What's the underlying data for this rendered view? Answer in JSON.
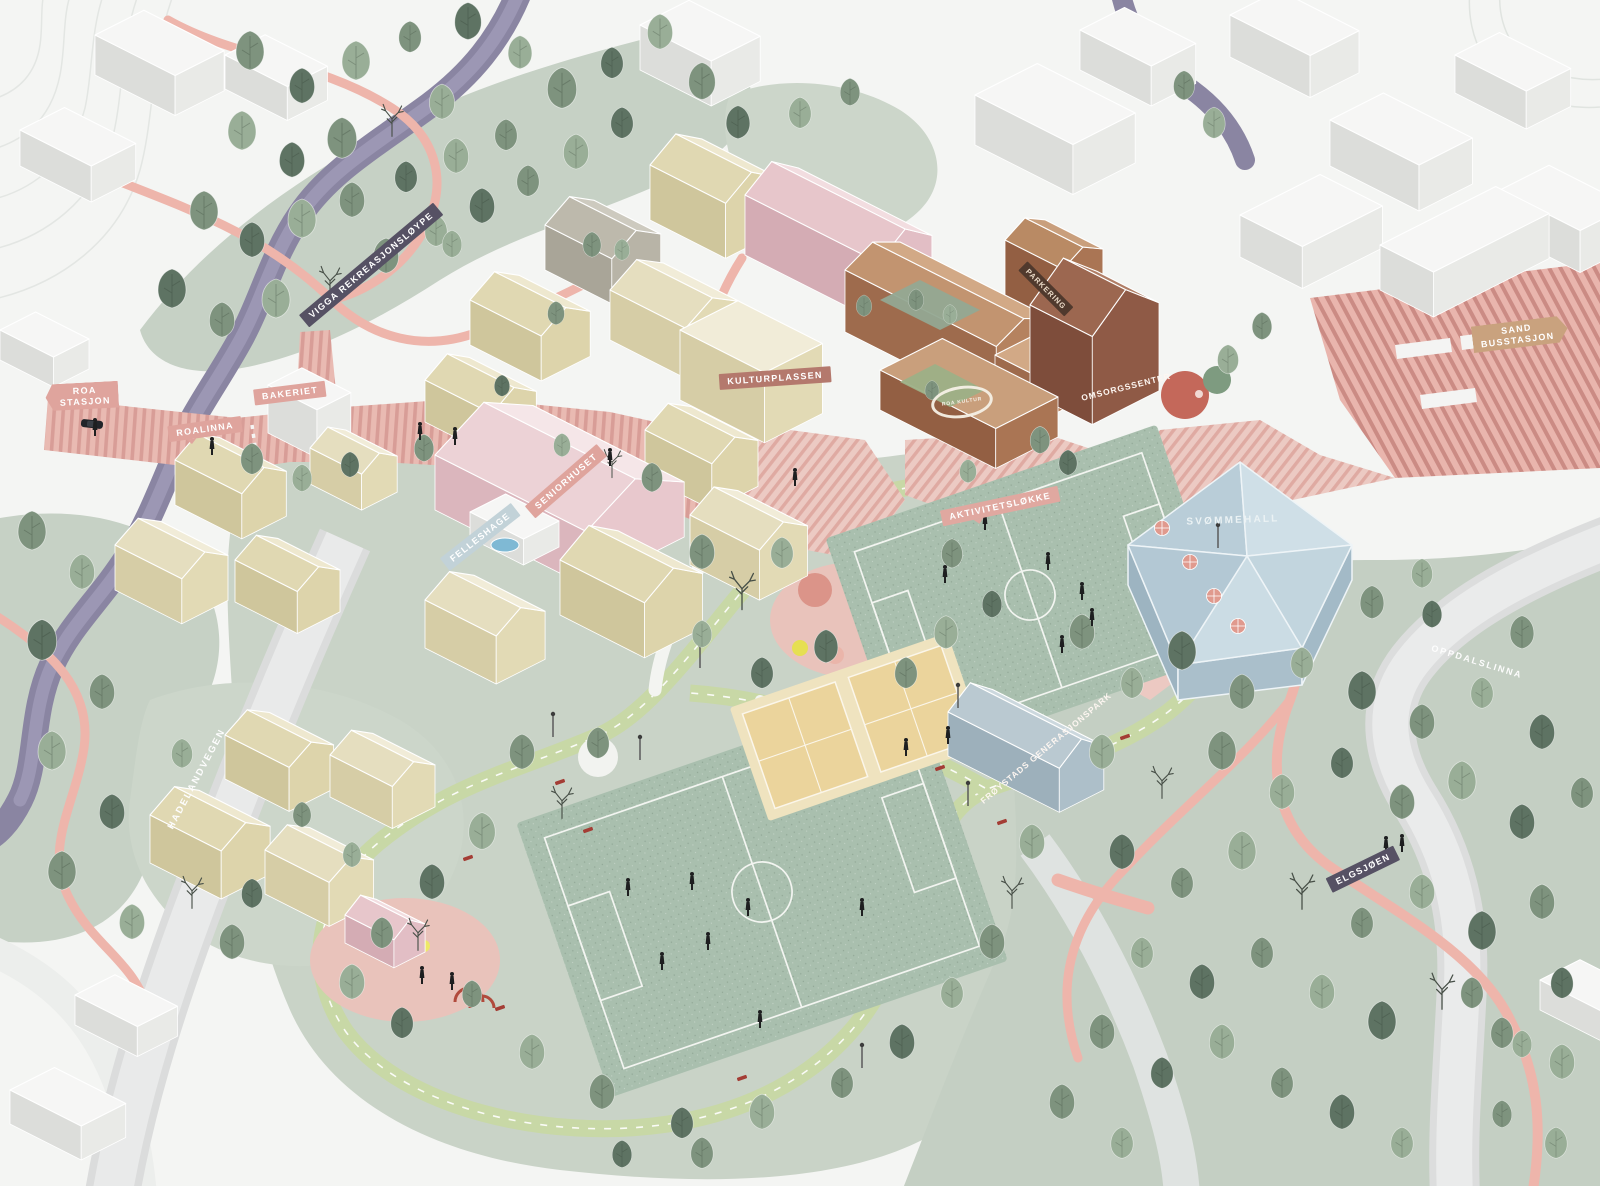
{
  "labels": {
    "vigga": "VIGGA REKREASJONSLØYPE",
    "roa_stasjon": "ROA\nSTASJON",
    "roalinna": "ROALINNA",
    "bakeriet": "BAKERIET",
    "seniorhuset": "SENIORHUSET",
    "felleshage": "FELLESHAGE",
    "kulturplassen": "KULTURPLASSEN",
    "parkering": "PARKERING",
    "roa_kultur_ring": "ROA KULTUR",
    "omsorgssenter": "OMSORGSSENTER",
    "sand_busstasjon": "SAND\nBUSSTASJON",
    "aktivitetslokke": "AKTIVITETSLØKKE",
    "svommehall": "SVØMMEHALL",
    "froystads_generasjonspark": "FRØYSTADS GENERASJONSPARK",
    "elgsjoen": "ELGSJØEN",
    "hadelandvegen": "HADELANDVEGEN",
    "oppdalslinna": "OPPDALSLINNA"
  },
  "colors": {
    "tag_pink": "#dfa49d",
    "tag_dark_purple": "#565164",
    "tag_rose_brown": "#b4796d",
    "tag_tan": "#c9a27e",
    "tag_dark_brown": "#50392d",
    "tag_light_blue": "#c2d2d8",
    "path_pink": "#eeb5ab",
    "striped_street_pink": "#e9bab2",
    "field_green": "#a9bfae",
    "park_green": "#c9d3c7",
    "loop_green": "#c8d8a6",
    "river_purple": "#8a85a2",
    "road_grey": "#dbdcdc",
    "building_yellow": "#e4dcb8",
    "building_pink": "#e8c8cd",
    "building_brown": "#b5825f",
    "building_dark_brown": "#8f5a46",
    "swimming_hall_blue": "#c8dae2",
    "court_yellow": "#ebd49c"
  }
}
